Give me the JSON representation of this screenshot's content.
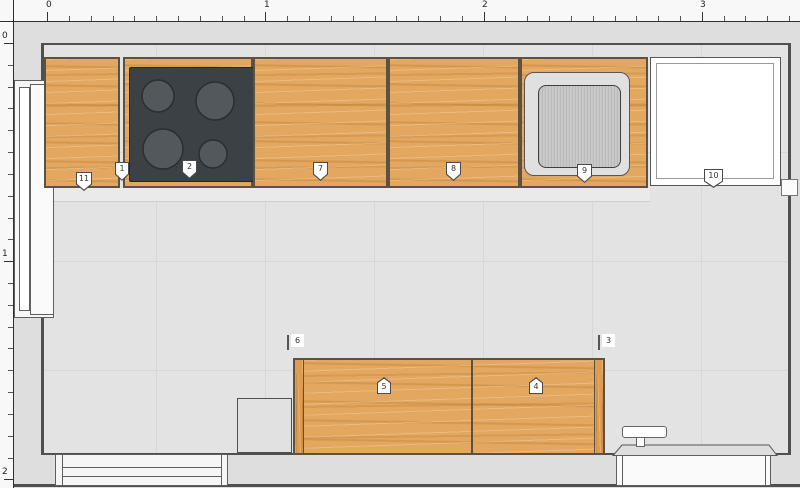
{
  "rulers": {
    "top": {
      "units": [
        "0",
        "1",
        "2",
        "3"
      ]
    },
    "left": {
      "units": [
        "0",
        "1",
        "2"
      ]
    }
  },
  "markers": {
    "m1": "1",
    "m2": "2",
    "m3": "3",
    "m4": "4",
    "m5": "5",
    "m6": "6",
    "m7": "7",
    "m8": "8",
    "m9": "9",
    "m10": "10",
    "m11": "11"
  },
  "colors": {
    "wood": "#e3a75f",
    "wood_grain": "#c98f45",
    "cooktop": "#3c4146",
    "burner": "#53585d",
    "sink_surround": "#e0e0e0",
    "sink_basin": "#c7c7c7",
    "appliance": "#ffffff",
    "wall": "#4f4f4f",
    "floor": "#e3e3e3",
    "ruler_bg": "#f8f8f8"
  }
}
